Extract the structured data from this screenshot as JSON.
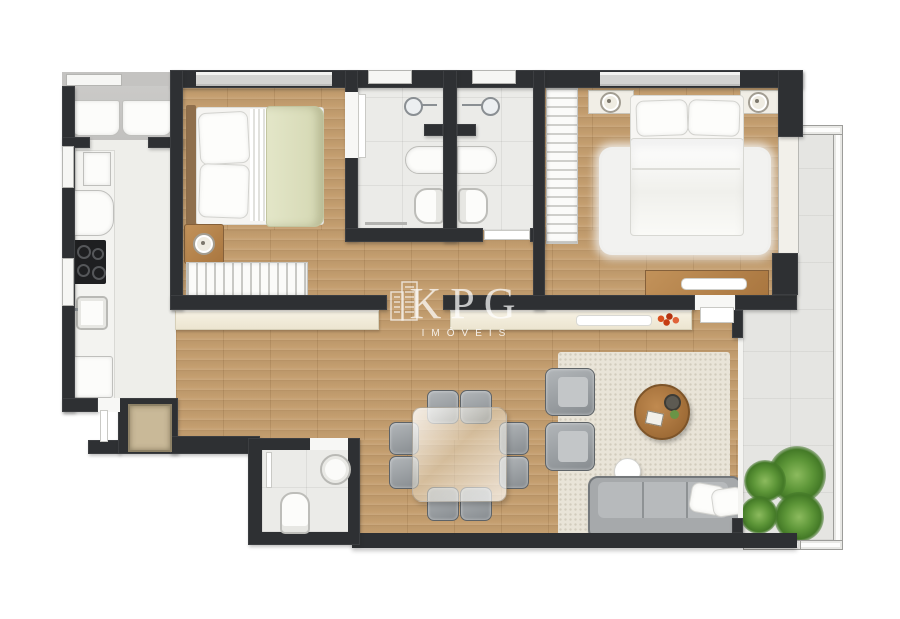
{
  "watermark": {
    "brand": "KPG",
    "subtitle": "IMÓVEIS",
    "icon": "buildings-icon"
  },
  "palette": {
    "wall": "#2e3033",
    "wood_floor": "#c49e6f",
    "bath_tile": "#ebebe8",
    "balcony_tile": "#e5e5e2",
    "service_floor": "#c6c5c3",
    "kitchen_floor": "#eeeeea",
    "living_rug": "#e9e4d8",
    "bedroom_rug": "#f2f2f0",
    "sofa_gray": "#a6a9ab",
    "furniture_wood": "#b9854e",
    "blanket_sage": "#d9dcba",
    "console_cream": "#f1ebdb",
    "plant_green": "#4e8a33",
    "flower_red": "#c63c12"
  },
  "rooms": [
    {
      "name": "laundry-service",
      "furniture": [
        "washer",
        "dryer"
      ]
    },
    {
      "name": "kitchen",
      "furniture": [
        "wall-oven",
        "refrigerator",
        "cooktop",
        "sink",
        "dishwasher",
        "heater-cabinet"
      ]
    },
    {
      "name": "bedroom-1",
      "furniture": [
        "double-bed",
        "nightstand",
        "table-lamp",
        "wardrobe"
      ],
      "features": [
        "window"
      ]
    },
    {
      "name": "bathroom-1",
      "furniture": [
        "shower",
        "vanity-counter",
        "toilet",
        "towel-bar"
      ],
      "features": [
        "window"
      ]
    },
    {
      "name": "bathroom-2",
      "furniture": [
        "shower",
        "vanity-counter",
        "toilet"
      ],
      "features": [
        "window"
      ]
    },
    {
      "name": "bedroom-2",
      "furniture": [
        "double-bed",
        "nightstand-left",
        "nightstand-right",
        "shag-rug",
        "dresser",
        "open-closet"
      ],
      "features": [
        "window",
        "balcony-door"
      ]
    },
    {
      "name": "powder-room",
      "furniture": [
        "toilet",
        "round-sink"
      ]
    },
    {
      "name": "dining-area",
      "furniture": [
        "glass-square-table",
        "chair-x8",
        "sideboard-x2"
      ]
    },
    {
      "name": "living-area",
      "furniture": [
        "sofa",
        "throw-pillow-x2",
        "armchair-x2",
        "round-coffee-table",
        "side-table",
        "area-rug"
      ]
    },
    {
      "name": "balcony",
      "furniture": [
        "plant-cluster"
      ],
      "features": [
        "glass-railing",
        "tile-floor"
      ]
    }
  ]
}
